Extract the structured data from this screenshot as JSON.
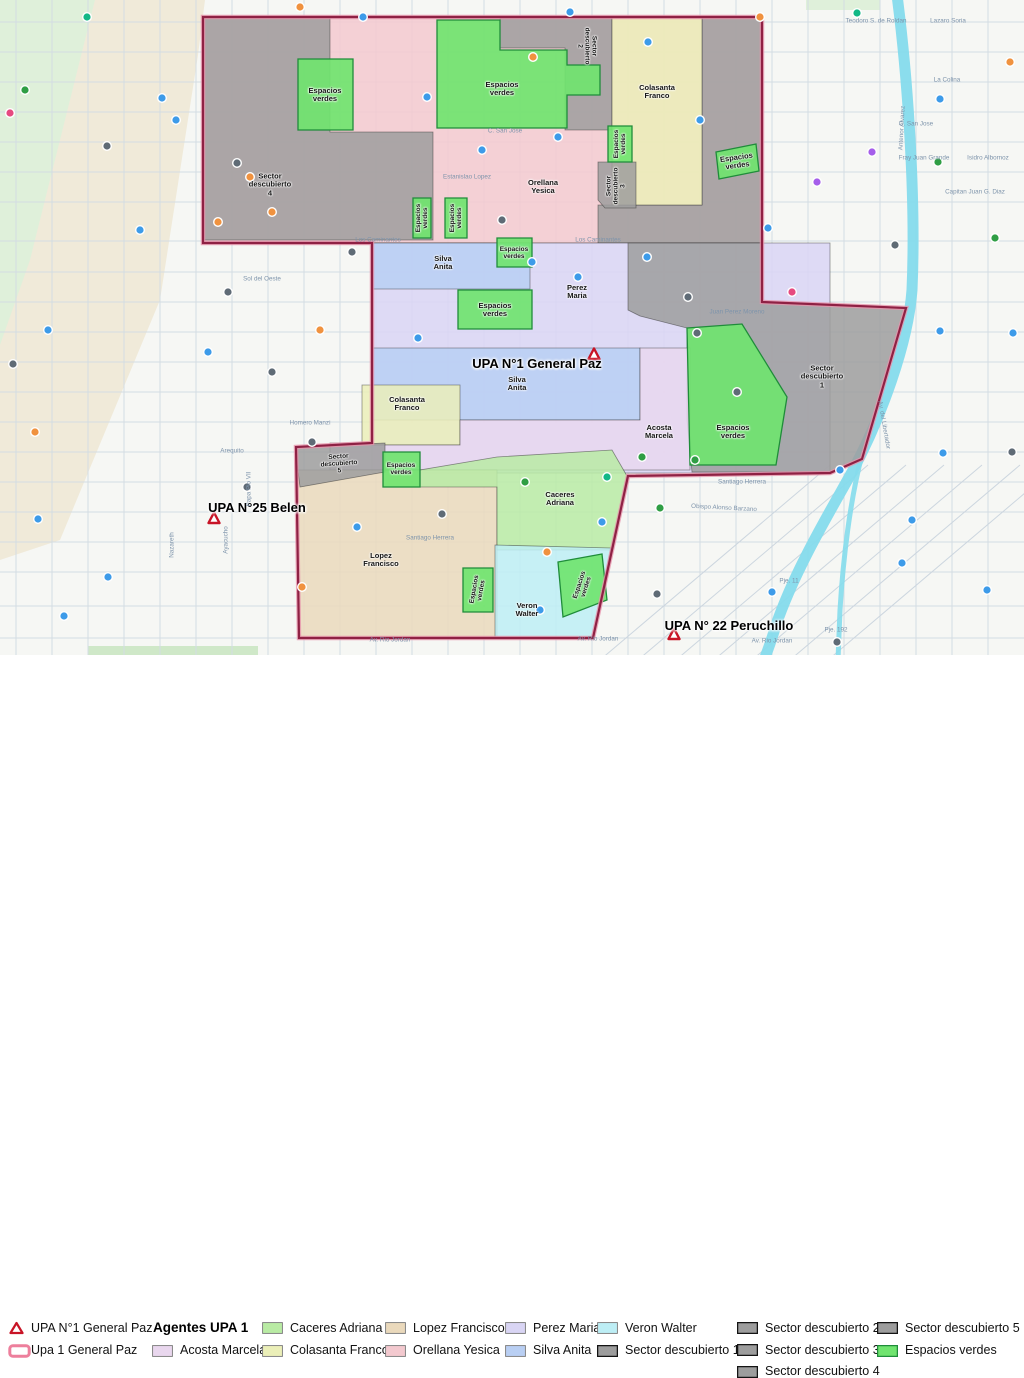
{
  "title": "UPA 1 General Paz sector map",
  "colors": {
    "orellana": "#f3c9cf",
    "colasanta": "#ebefb8",
    "caceres": "#b9eba4",
    "lopez": "#ead9bc",
    "perez": "#d9d5f4",
    "silva": "#b9cff3",
    "veron": "#bdeef5",
    "acosta": "#e9d7ee",
    "sector": "#9d9d9d",
    "espacios": "#70e46f",
    "espacios_border": "#1f8c3a",
    "boundary": "#8f2144",
    "boundary_halo": "#e794ab",
    "river": "#85dbec",
    "triangle": "#c81426",
    "area_swatch_border": "#ed7f9c",
    "poi": {
      "o": "#f0923f",
      "b": "#3d9be9",
      "g": "#2f9e44",
      "p": "#a55eea",
      "k": "#5f6b76",
      "t": "#12b886",
      "m": "#e64980"
    }
  },
  "map": {
    "region_labels": [
      {
        "name": "label-sector-descubierto-4",
        "text": "Sector\ndescubierto\n4",
        "x": 270,
        "y": 185,
        "rot": 0
      },
      {
        "name": "label-espacios-verdes",
        "text": "Espacios\nverdes",
        "x": 325,
        "y": 95,
        "rot": 0
      },
      {
        "name": "label-espacios-verdes",
        "text": "Espacios\nverdes",
        "x": 502,
        "y": 89,
        "rot": 0
      },
      {
        "name": "label-sector-descubierto-2",
        "text": "Sector\ndescubierto\n2",
        "x": 587,
        "y": 46,
        "rot": 90,
        "fs": 6.5
      },
      {
        "name": "label-colasanta-franco",
        "text": "Colasanta\nFranco",
        "x": 657,
        "y": 92,
        "rot": 0
      },
      {
        "name": "label-orellana-yesica",
        "text": "Orellana\nYesica",
        "x": 543,
        "y": 187,
        "rot": 0
      },
      {
        "name": "label-espacios-verdes",
        "text": "Espacios\nverdes",
        "x": 422,
        "y": 218,
        "rot": -90,
        "fs": 6.5
      },
      {
        "name": "label-espacios-verdes",
        "text": "Espacios\nverdes",
        "x": 456,
        "y": 218,
        "rot": -90,
        "fs": 6.5
      },
      {
        "name": "label-espacios-verdes",
        "text": "Espacios\nverdes",
        "x": 620,
        "y": 144,
        "rot": -90,
        "fs": 6.5
      },
      {
        "name": "label-sector-descubierto-3",
        "text": "Sector\ndescubierto\n3",
        "x": 616,
        "y": 186,
        "rot": -90,
        "fs": 6.5
      },
      {
        "name": "label-espacios-verdes",
        "text": "Espacios\nverdes",
        "x": 737,
        "y": 162,
        "rot": -8
      },
      {
        "name": "label-silva-anita",
        "text": "Silva\nAnita",
        "x": 443,
        "y": 263,
        "rot": 0
      },
      {
        "name": "label-espacios-verdes",
        "text": "Espacios\nverdes",
        "x": 514,
        "y": 253,
        "rot": 0,
        "fs": 6.5
      },
      {
        "name": "label-perez-maria",
        "text": "Perez\nMaria",
        "x": 577,
        "y": 292,
        "rot": 0
      },
      {
        "name": "label-espacios-verdes",
        "text": "Espacios\nverdes",
        "x": 495,
        "y": 310,
        "rot": 0
      },
      {
        "name": "label-silva-anita",
        "text": "Silva\nAnita",
        "x": 517,
        "y": 384,
        "rot": 0
      },
      {
        "name": "label-colasanta-franco",
        "text": "Colasanta\nFranco",
        "x": 407,
        "y": 404,
        "rot": 0
      },
      {
        "name": "label-acosta-marcela",
        "text": "Acosta\nMarcela",
        "x": 659,
        "y": 432,
        "rot": 0
      },
      {
        "name": "label-sector-descubierto-1",
        "text": "Sector\ndescubierto\n1",
        "x": 822,
        "y": 377,
        "rot": 0
      },
      {
        "name": "label-espacios-verdes",
        "text": "Espacios\nverdes",
        "x": 733,
        "y": 432,
        "rot": 0
      },
      {
        "name": "label-sector-descubierto-5",
        "text": "Sector\ndescubierto\n5",
        "x": 339,
        "y": 464,
        "rot": -4,
        "fs": 6.5
      },
      {
        "name": "label-espacios-verdes",
        "text": "Espacios\nverdes",
        "x": 401,
        "y": 469,
        "rot": 0,
        "fs": 6.5
      },
      {
        "name": "label-lopez-francisco",
        "text": "Lopez\nFrancisco",
        "x": 381,
        "y": 560,
        "rot": 0
      },
      {
        "name": "label-caceres-adriana",
        "text": "Caceres\nAdriana",
        "x": 560,
        "y": 499,
        "rot": 0
      },
      {
        "name": "label-veron-walter",
        "text": "Veron\nWalter",
        "x": 527,
        "y": 610,
        "rot": 0
      },
      {
        "name": "label-espacios-verdes",
        "text": "Espacios\nverdes",
        "x": 478,
        "y": 590,
        "rot": -80,
        "fs": 6.5
      },
      {
        "name": "label-espacios-verdes",
        "text": "Espacios\nverdes",
        "x": 583,
        "y": 586,
        "rot": -72,
        "fs": 6.5
      },
      {
        "name": "label-upa-1-general-paz",
        "text": "UPA N°1 General Paz",
        "x": 537,
        "y": 364,
        "rot": 0,
        "cls": "upa"
      },
      {
        "name": "label-upa-25-belen",
        "text": "UPA N°25 Belen",
        "x": 257,
        "y": 508,
        "rot": 0,
        "cls": "upa"
      },
      {
        "name": "label-upa-22-peruchillo",
        "text": "UPA N° 22 Peruchillo",
        "x": 729,
        "y": 626,
        "rot": 0,
        "cls": "upa"
      }
    ],
    "street_labels": [
      {
        "text": "Los Caminantes",
        "x": 378,
        "y": 240,
        "rot": 0
      },
      {
        "text": "Los Caminantes",
        "x": 598,
        "y": 240,
        "rot": 0
      },
      {
        "text": "Av. Rio Jordan",
        "x": 390,
        "y": 640,
        "rot": 0
      },
      {
        "text": "Av. Rio Jordan",
        "x": 598,
        "y": 639,
        "rot": 0
      },
      {
        "text": "Av. Rio Jordan",
        "x": 772,
        "y": 641,
        "rot": 0
      },
      {
        "text": "C. San Jose",
        "x": 505,
        "y": 131,
        "rot": 0
      },
      {
        "text": "Estanislao Lopez",
        "x": 467,
        "y": 177,
        "rot": 0
      },
      {
        "text": "Juan Perez Moreno",
        "x": 737,
        "y": 312,
        "rot": 0
      },
      {
        "text": "Teodoro S. de Roldan",
        "x": 876,
        "y": 21,
        "rot": 0
      },
      {
        "text": "Lazaro Soria",
        "x": 948,
        "y": 21,
        "rot": 0
      },
      {
        "text": "Fray Juan Grande",
        "x": 924,
        "y": 158,
        "rot": 0
      },
      {
        "text": "Isidro Albornoz",
        "x": 988,
        "y": 158,
        "rot": 0
      },
      {
        "text": "C. San Jose",
        "x": 916,
        "y": 124,
        "rot": 0
      },
      {
        "text": "Av. del Libertador",
        "x": 884,
        "y": 425,
        "rot": 80
      },
      {
        "text": "Santiago Herrera",
        "x": 742,
        "y": 482,
        "rot": 0
      },
      {
        "text": "Obispo Alonso Barzano",
        "x": 724,
        "y": 508,
        "rot": 3
      },
      {
        "text": "Homero Manzi",
        "x": 310,
        "y": 423,
        "rot": 0
      },
      {
        "text": "Sol del Oeste",
        "x": 262,
        "y": 279,
        "rot": 0
      },
      {
        "text": "Arequito",
        "x": 232,
        "y": 451,
        "rot": 0
      },
      {
        "text": "Nazareth",
        "x": 172,
        "y": 545,
        "rot": -90
      },
      {
        "text": "Ayacucho",
        "x": 226,
        "y": 540,
        "rot": -90
      },
      {
        "text": "Papa Pio VII",
        "x": 249,
        "y": 489,
        "rot": -90
      },
      {
        "text": "Pje. 11",
        "x": 789,
        "y": 581,
        "rot": 0
      },
      {
        "text": "Pje. 192",
        "x": 836,
        "y": 630,
        "rot": 0
      },
      {
        "text": "Antenor Alvarez",
        "x": 902,
        "y": 128,
        "rot": -87
      },
      {
        "text": "La Colina",
        "x": 947,
        "y": 80,
        "rot": 0
      },
      {
        "text": "Capitan Juan G. Diaz",
        "x": 975,
        "y": 192,
        "rot": 0
      },
      {
        "text": "Santiago Herrera",
        "x": 430,
        "y": 538,
        "rot": 0
      }
    ],
    "poi": [
      [
        87,
        17,
        "t"
      ],
      [
        300,
        7,
        "o"
      ],
      [
        363,
        17,
        "b"
      ],
      [
        533,
        57,
        "o"
      ],
      [
        570,
        12,
        "b"
      ],
      [
        648,
        42,
        "b"
      ],
      [
        760,
        17,
        "o"
      ],
      [
        857,
        13,
        "t"
      ],
      [
        940,
        99,
        "b"
      ],
      [
        1010,
        62,
        "o"
      ],
      [
        938,
        162,
        "g"
      ],
      [
        995,
        238,
        "g"
      ],
      [
        25,
        90,
        "g"
      ],
      [
        162,
        98,
        "b"
      ],
      [
        107,
        146,
        "k"
      ],
      [
        10,
        113,
        "m"
      ],
      [
        140,
        230,
        "b"
      ],
      [
        48,
        330,
        "b"
      ],
      [
        13,
        364,
        "k"
      ],
      [
        35,
        432,
        "o"
      ],
      [
        38,
        519,
        "b"
      ],
      [
        108,
        577,
        "b"
      ],
      [
        64,
        616,
        "b"
      ],
      [
        237,
        163,
        "k"
      ],
      [
        272,
        212,
        "o"
      ],
      [
        250,
        177,
        "o"
      ],
      [
        352,
        252,
        "k"
      ],
      [
        228,
        292,
        "k"
      ],
      [
        208,
        352,
        "b"
      ],
      [
        272,
        372,
        "k"
      ],
      [
        312,
        442,
        "k"
      ],
      [
        247,
        487,
        "k"
      ],
      [
        357,
        527,
        "b"
      ],
      [
        302,
        587,
        "o"
      ],
      [
        427,
        97,
        "b"
      ],
      [
        482,
        150,
        "b"
      ],
      [
        558,
        137,
        "b"
      ],
      [
        502,
        220,
        "k"
      ],
      [
        532,
        262,
        "b"
      ],
      [
        578,
        277,
        "b"
      ],
      [
        647,
        257,
        "b"
      ],
      [
        688,
        297,
        "k"
      ],
      [
        697,
        333,
        "k"
      ],
      [
        737,
        392,
        "k"
      ],
      [
        642,
        457,
        "g"
      ],
      [
        602,
        522,
        "b"
      ],
      [
        547,
        552,
        "o"
      ],
      [
        442,
        514,
        "k"
      ],
      [
        525,
        482,
        "g"
      ],
      [
        607,
        477,
        "t"
      ],
      [
        657,
        594,
        "k"
      ],
      [
        817,
        182,
        "p"
      ],
      [
        792,
        292,
        "m"
      ],
      [
        872,
        152,
        "p"
      ],
      [
        700,
        120,
        "b"
      ],
      [
        768,
        228,
        "b"
      ],
      [
        895,
        245,
        "k"
      ],
      [
        840,
        470,
        "b"
      ],
      [
        912,
        520,
        "b"
      ],
      [
        1013,
        333,
        "b"
      ],
      [
        940,
        331,
        "b"
      ],
      [
        943,
        453,
        "b"
      ],
      [
        1012,
        452,
        "k"
      ],
      [
        772,
        592,
        "b"
      ],
      [
        837,
        642,
        "k"
      ],
      [
        902,
        563,
        "b"
      ],
      [
        987,
        590,
        "b"
      ],
      [
        320,
        330,
        "o"
      ],
      [
        218,
        222,
        "o"
      ],
      [
        176,
        120,
        "b"
      ],
      [
        418,
        338,
        "b"
      ],
      [
        695,
        460,
        "g"
      ],
      [
        540,
        610,
        "b"
      ],
      [
        660,
        508,
        "g"
      ]
    ]
  },
  "legend": {
    "point_label": "UPA N°1 General Paz",
    "area_label": "Upa 1 General Paz",
    "agents_header": "Agentes UPA 1",
    "agents": {
      "acosta": "Acosta Marcela",
      "caceres": "Caceres Adriana",
      "colasanta": "Colasanta Franco",
      "lopez": "Lopez Francisco",
      "orellana": "Orellana Yesica",
      "perez": "Perez Maria",
      "silva": "Silva Anita",
      "veron": "Veron Walter"
    },
    "sectors": {
      "s1": "Sector descubierto 1",
      "s2": "Sector descubierto 2",
      "s3": "Sector descubierto 3",
      "s4": "Sector descubierto 4",
      "s5": "Sector descubierto 5"
    },
    "espacios": "Espacios verdes"
  }
}
